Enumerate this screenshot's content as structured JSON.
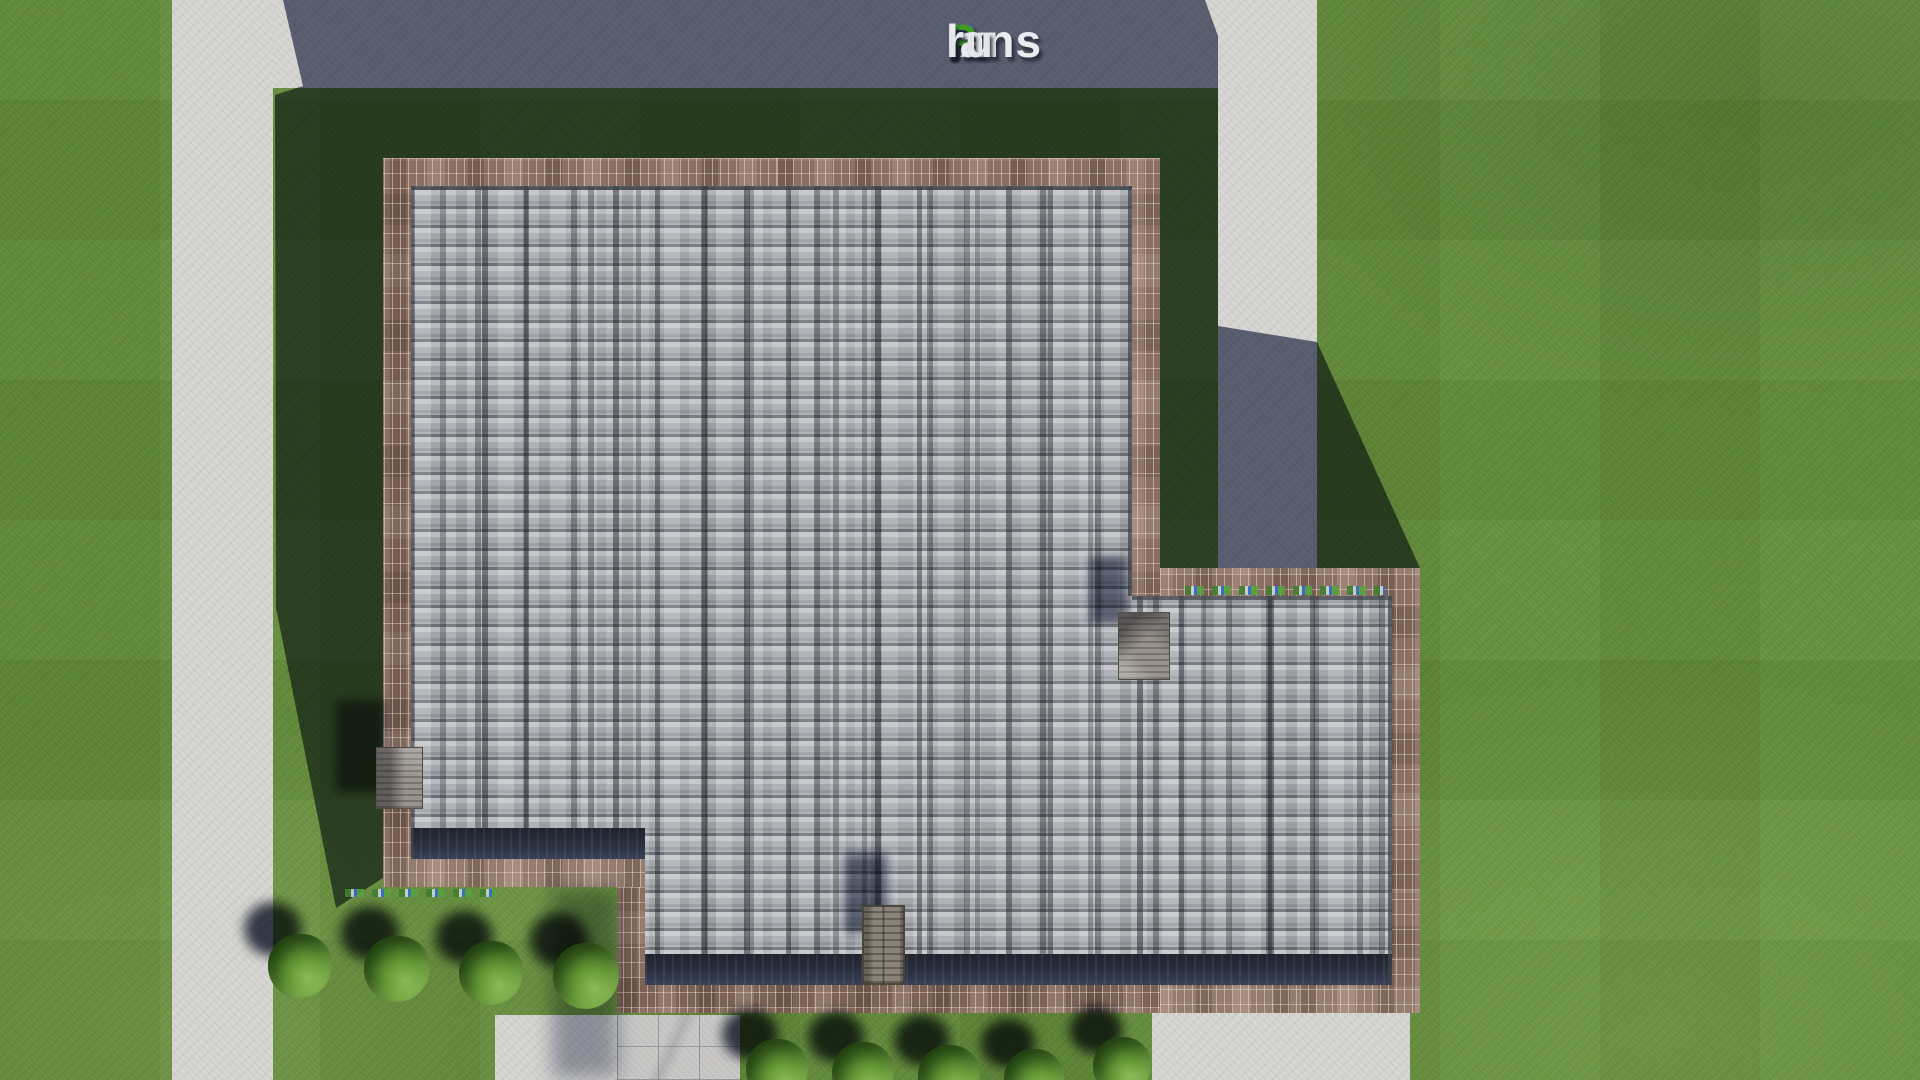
{
  "page": {
    "kind": "aerial-3d-site-plan-render",
    "subject": "top-down view of a house roof with brick parapet, gray asphalt shingles, concrete paths, lawn, bushes and a row of parked vehicles"
  },
  "watermark": {
    "text": "FixPlans.ru",
    "segments": [
      {
        "text": "F",
        "color": "#2f6bdb"
      },
      {
        "text": "ix",
        "color": "#eef0f4"
      },
      {
        "text": "P",
        "color": "#3f9e22"
      },
      {
        "text": "lans",
        "color": "#eef0f4"
      },
      {
        "text": ".",
        "color": "#2f6bdb"
      },
      {
        "text": "ru",
        "color": "#e8eaef"
      }
    ]
  },
  "vehicles": {
    "count": 10,
    "colors": [
      "#cdd0d6",
      "#e3e4e8",
      "#2b59c8",
      "#eceef1",
      "#d8dade",
      "#c8ccd2",
      "#e0e2e6",
      "#d2d5da",
      "#2f9e2f",
      "#dcdee2"
    ]
  },
  "scene": {
    "bush_count": 9,
    "roof_features": [
      "left-bay-roof",
      "right-bay-roof",
      "chimney"
    ],
    "palette": {
      "lawn": "#67913d",
      "lawn_in_shadow": "#2a3f20",
      "pavement": "#d8d7d4",
      "pavement_in_shadow": "#585d6e",
      "brick_parapet": "#8a6f62",
      "shingles": "#a9adb1",
      "eave_shadow": "#262b36",
      "bush": "#477526",
      "vehicle_blue": "#2b59c8",
      "vehicle_green": "#2f9e2f"
    }
  }
}
